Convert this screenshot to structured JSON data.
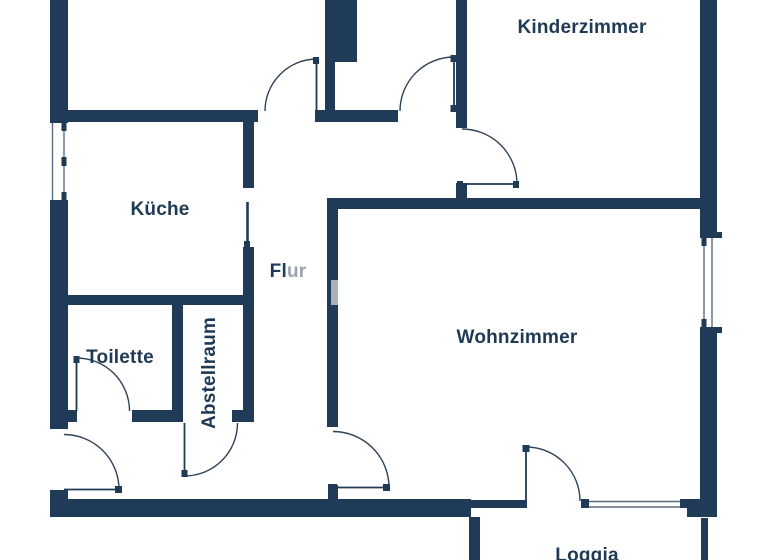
{
  "palette": {
    "wall": "#1f3b57",
    "arc_line": "#2f4257",
    "window_line": "#5a6b7d",
    "label": "#1e3a54",
    "label_muted": "#9ba3ae",
    "inset": "#a8b0ba",
    "background": "#ffffff"
  },
  "labels": {
    "kinderzimmer": "Kinderzimmer",
    "kueche": "Küche",
    "flur_dark": "Fl",
    "flur_muted": "ur",
    "toilette": "Toilette",
    "abstellraum": "Abstellraum",
    "wohnzimmer": "Wohnzimmer",
    "loggia": "Loggia"
  },
  "floorplan": {
    "walls": [
      [
        50,
        0,
        18,
        123
      ],
      [
        50,
        200,
        18,
        229
      ],
      [
        50,
        490,
        18,
        27
      ],
      [
        50,
        110,
        208,
        12
      ],
      [
        315,
        110,
        83,
        12
      ],
      [
        325,
        0,
        32,
        62
      ],
      [
        325,
        62,
        10,
        49
      ],
      [
        456,
        0,
        11,
        128
      ],
      [
        456,
        183,
        11,
        16
      ],
      [
        243,
        110,
        11,
        78
      ],
      [
        243,
        247,
        11,
        165
      ],
      [
        50,
        295,
        204,
        10
      ],
      [
        172,
        305,
        11,
        105
      ],
      [
        68,
        410,
        9,
        12
      ],
      [
        132,
        410,
        51,
        12
      ],
      [
        232,
        410,
        22,
        12
      ],
      [
        327,
        198,
        11,
        229
      ],
      [
        328,
        485,
        10,
        15
      ],
      [
        327,
        198,
        373,
        11
      ],
      [
        50,
        499,
        421,
        18
      ],
      [
        471,
        500,
        56,
        8
      ],
      [
        700,
        0,
        17,
        238
      ],
      [
        700,
        327,
        17,
        190
      ],
      [
        687,
        499,
        13,
        18
      ],
      [
        700,
        232,
        22,
        6
      ],
      [
        700,
        327,
        22,
        6
      ],
      [
        469,
        517,
        11,
        43
      ],
      [
        701,
        518,
        7,
        42
      ]
    ],
    "doors": [
      {
        "name": "top-left-room-door",
        "arc": "M 317 59 A 52 52 0 0 0 265 111",
        "leaf": [
          316.5,
          59,
          316.5,
          111
        ],
        "caps": [
          [
            313,
            57,
            6,
            7
          ]
        ]
      },
      {
        "name": "top-middle-room-door",
        "arc": "M 454 57 A 54 54 0 0 0 400 111",
        "leaf": [
          454,
          57,
          454,
          111
        ],
        "caps": [
          [
            450.5,
            55,
            7,
            7
          ],
          [
            450.5,
            105,
            7,
            7
          ]
        ]
      },
      {
        "name": "kinderzimmer-door",
        "arc": "M 462 129 A 55 55 0 0 1 517 184",
        "leaf": [
          462,
          184,
          518,
          184
        ],
        "caps": [
          [
            457,
            181,
            6,
            7
          ],
          [
            513,
            181,
            6,
            7
          ]
        ]
      },
      {
        "name": "toilette-door",
        "arc": "M 76.5 358 A 53 53 0 0 1 129.5 411",
        "leaf": [
          76.5,
          358,
          76.5,
          411
        ],
        "caps": [
          [
            73.5,
            356,
            6,
            7
          ]
        ]
      },
      {
        "name": "abstellraum-door",
        "arc": "M 184.5 476 A 53 53 0 0 0 237.5 423",
        "leaf": [
          184.5,
          423,
          184.5,
          476
        ],
        "caps": [
          [
            181.5,
            470,
            6,
            7
          ]
        ]
      },
      {
        "name": "entrance-door",
        "arc": "M 64 434.5 A 55 55 0 0 1 119 489.5",
        "leaf": [
          64,
          489.5,
          119,
          489.5
        ],
        "caps": [
          [
            115,
            486,
            7,
            7
          ]
        ]
      },
      {
        "name": "wohnzimmer-door",
        "arc": "M 333 431.5 A 56 56 0 0 1 389 487.5",
        "leaf": [
          333,
          487.5,
          389,
          487.5
        ],
        "caps": [
          [
            328,
            484,
            9,
            7
          ],
          [
            383,
            484,
            7,
            7
          ]
        ]
      },
      {
        "name": "loggia-door",
        "arc": "M 526 447 A 54 54 0 0 1 580 501",
        "leaf": [
          526,
          447,
          526,
          501
        ],
        "caps": [
          [
            522.5,
            445,
            7,
            7
          ]
        ]
      }
    ],
    "sliding_doors": [
      {
        "name": "kueche-door",
        "line": [
          247.5,
          202,
          247.5,
          247
        ],
        "caps": [
          [
            244,
            241,
            6,
            6
          ]
        ]
      }
    ],
    "windows": [
      {
        "name": "kueche-window",
        "gap": [
          50,
          123,
          18,
          77
        ],
        "lines": [
          [
            52.5,
            123,
            52.5,
            200
          ],
          [
            64,
            123,
            64,
            200
          ]
        ],
        "ticks": [
          [
            61.5,
            123,
            5,
            8
          ],
          [
            61.5,
            157,
            5,
            9
          ],
          [
            61.5,
            192,
            5,
            8
          ]
        ]
      },
      {
        "name": "wohnzimmer-window-east",
        "gap": [
          700,
          238,
          17,
          89
        ],
        "lines": [
          [
            704,
            238,
            704,
            327
          ],
          [
            712,
            238,
            712,
            327
          ]
        ],
        "ticks": [
          [
            701.5,
            238,
            5,
            8
          ],
          [
            701.5,
            319,
            5,
            8
          ]
        ]
      },
      {
        "name": "loggia-window-south",
        "gap": null,
        "lines": [
          [
            589,
            501.5,
            681,
            501.5
          ],
          [
            589,
            507,
            681,
            507
          ]
        ],
        "ticks": [
          [
            581,
            499,
            8,
            9
          ],
          [
            680,
            499,
            9,
            9
          ]
        ]
      }
    ],
    "insets": [
      [
        331,
        280,
        7,
        25
      ]
    ]
  }
}
